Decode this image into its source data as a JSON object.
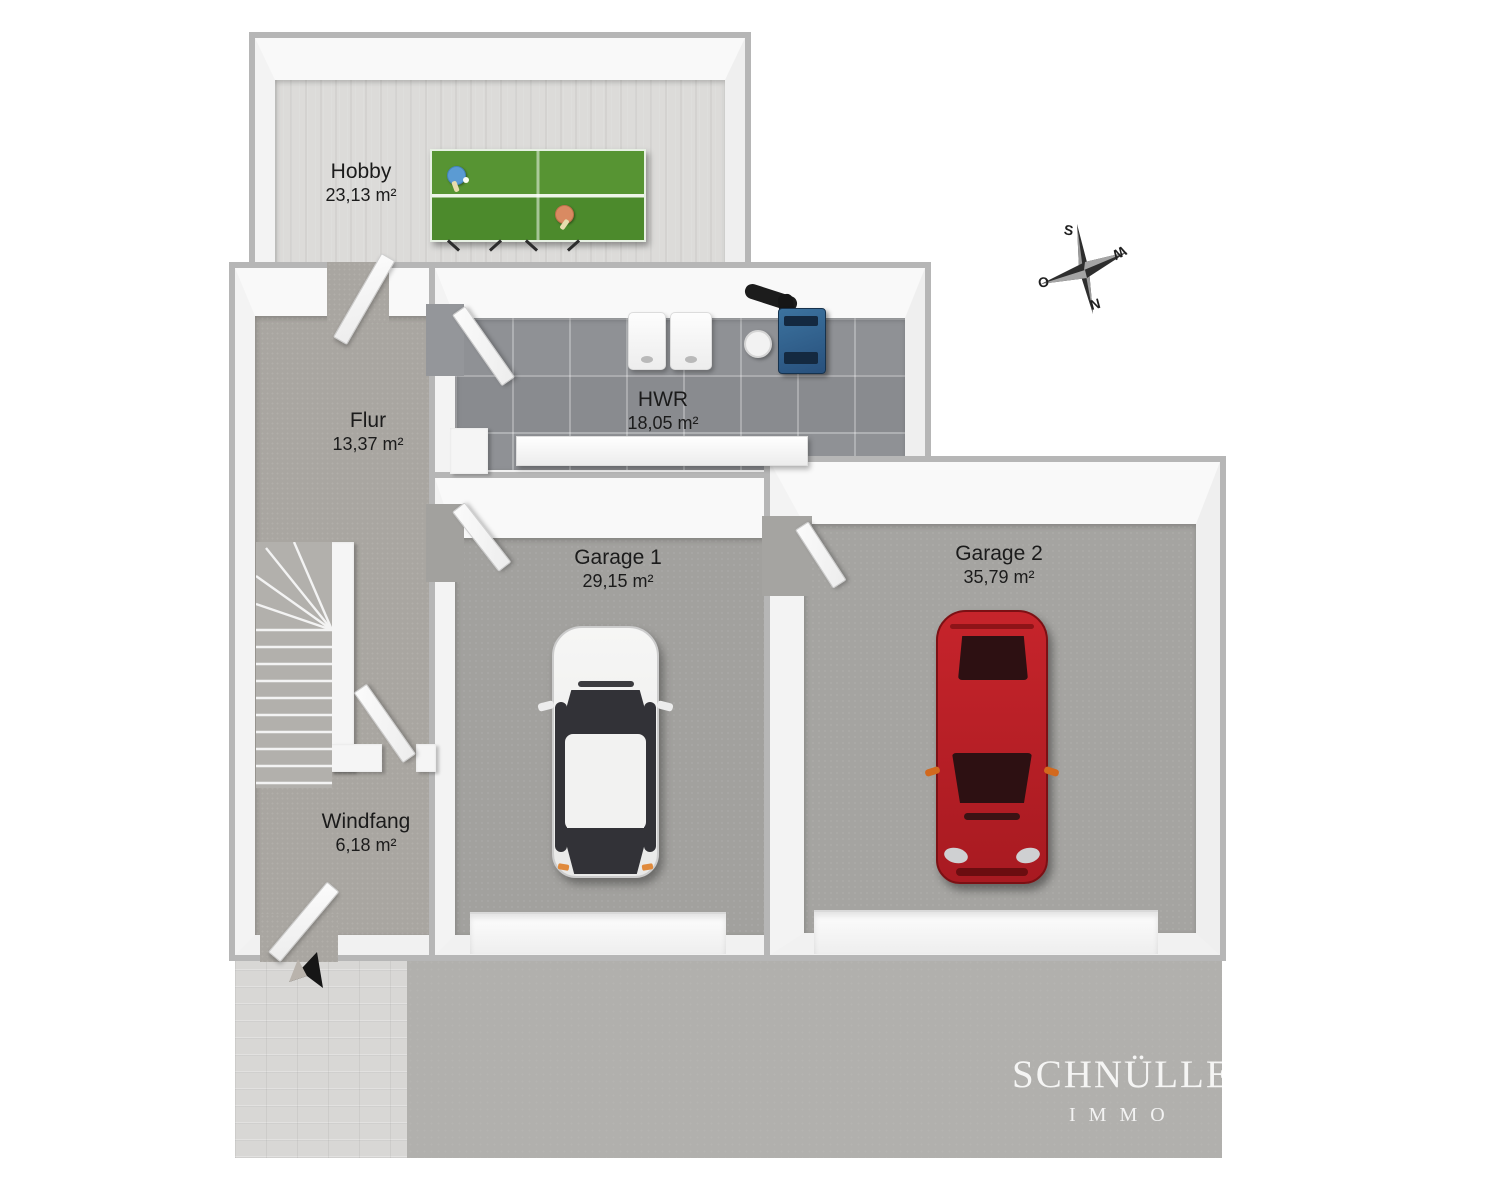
{
  "rooms": [
    {
      "label": "Hobby",
      "area": "23,13 m²"
    },
    {
      "label": "Flur",
      "area": "13,37 m²"
    },
    {
      "label": "HWR",
      "area": "18,05 m²"
    },
    {
      "label": "Garage 1",
      "area": "29,15 m²"
    },
    {
      "label": "Garage 2",
      "area": "35,79 m²"
    },
    {
      "label": "Windfang",
      "area": "6,18 m²"
    }
  ],
  "compass": {
    "letters": {
      "top": "S",
      "right": "W",
      "left": "O",
      "bottom": "N"
    }
  },
  "watermark": {
    "line1": "SCHNÜLLE & B",
    "line2": "IMMO"
  },
  "colors": {
    "wall": "#f5f5f5",
    "wall_edge": "#b6b6b6",
    "table_green": "#538f2e",
    "boiler_blue": "#30648f",
    "car_red": "#c1252b",
    "car_white": "#f4f4f4",
    "label_text": "#1b1b1b"
  }
}
